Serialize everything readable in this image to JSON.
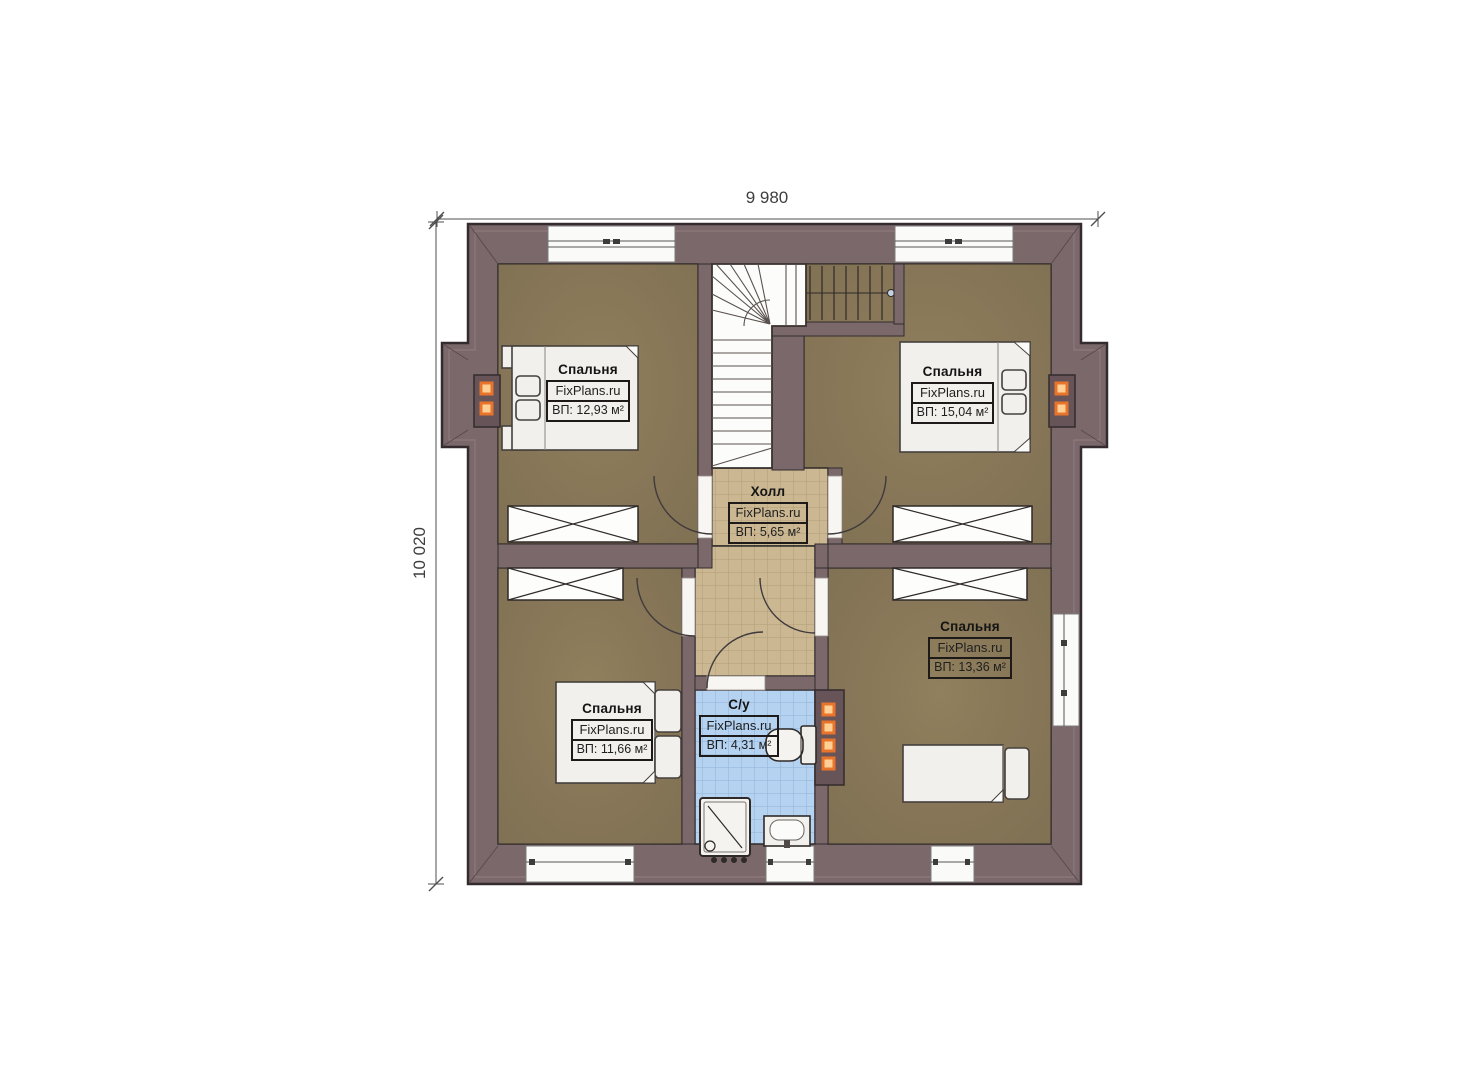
{
  "dimensions": {
    "width_label": "9 980",
    "height_label": "10 020"
  },
  "rooms": [
    {
      "id": "bedroom-top-left",
      "name": "Спальня",
      "brand": "FixPlans.ru",
      "area": "ВП: 12,93 м²"
    },
    {
      "id": "bedroom-top-right",
      "name": "Спальня",
      "brand": "FixPlans.ru",
      "area": "ВП: 15,04 м²"
    },
    {
      "id": "hall",
      "name": "Холл",
      "brand": "FixPlans.ru",
      "area": "ВП: 5,65 м²"
    },
    {
      "id": "bathroom",
      "name": "С/у",
      "brand": "FixPlans.ru",
      "area": "ВП: 4,31 м²"
    },
    {
      "id": "bedroom-bottom-left",
      "name": "Спальня",
      "brand": "FixPlans.ru",
      "area": "ВП: 11,66 м²"
    },
    {
      "id": "bedroom-bottom-right",
      "name": "Спальня",
      "brand": "FixPlans.ru",
      "area": "ВП: 13,36 м²"
    }
  ],
  "colors": {
    "wall": "#7b686b",
    "wall_outline": "#332b2d",
    "floor_wood": "#8a795b",
    "floor_hall_tile": "#cbb893",
    "floor_bath_tile": "#b5d2f0",
    "furniture": "#f1f0ec",
    "chimney_block": "#665458",
    "flue_orange": "#e8742b"
  }
}
